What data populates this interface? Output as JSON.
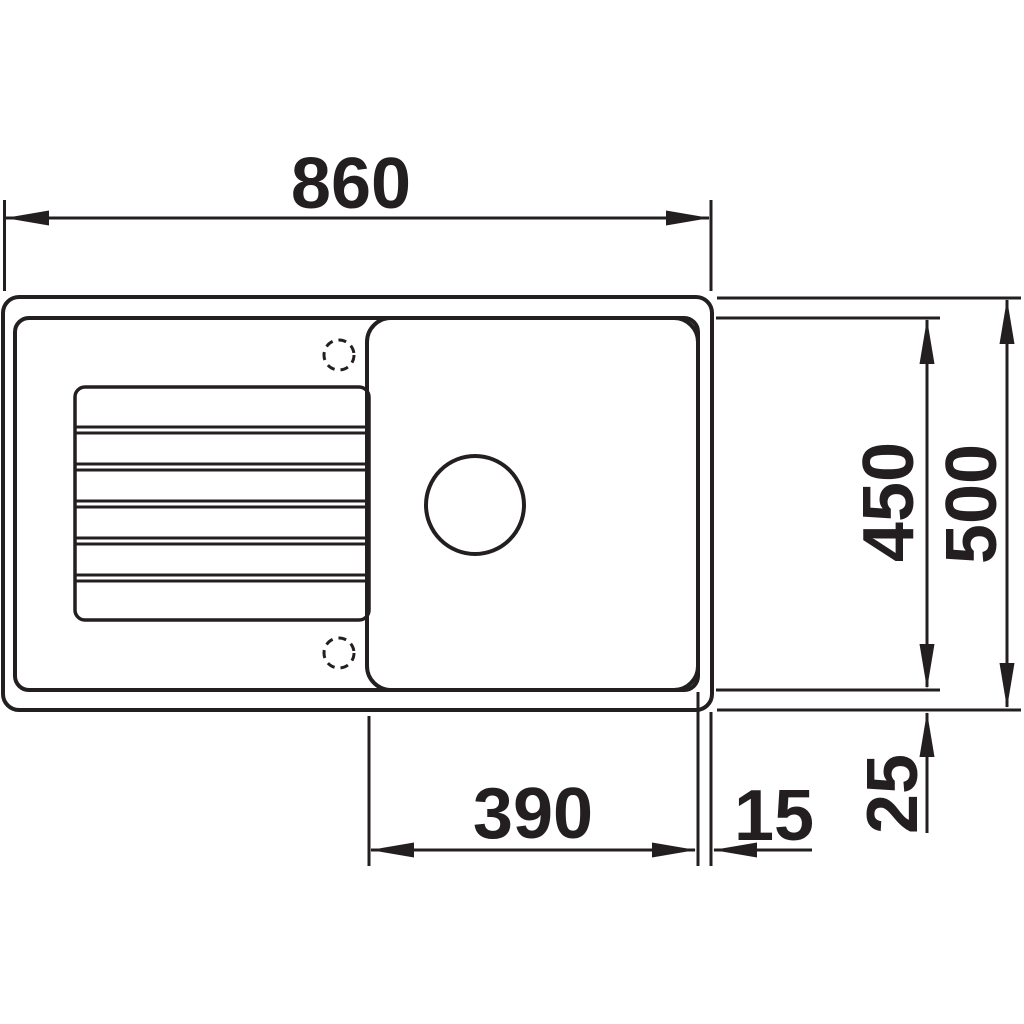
{
  "drawing": {
    "background_color": "#ffffff",
    "line_color": "#231f20",
    "labels": {
      "overall_width": "860",
      "inner_depth": "450",
      "overall_depth": "500",
      "bowl_width": "390",
      "rim_right": "15",
      "rim_bottom": "25"
    }
  }
}
